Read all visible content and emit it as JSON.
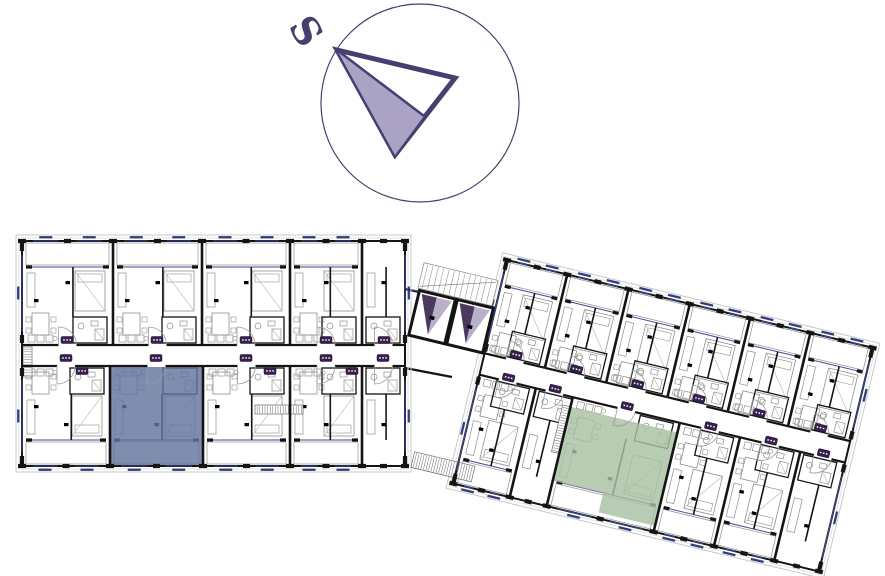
{
  "compass": {
    "label": "S",
    "cx": 420,
    "cy": 103,
    "r": 99,
    "ring_color": "#43406e",
    "arrow_outline": "#463f70",
    "arrow_fill": "#aba3c6",
    "label_color": "#463f70",
    "tip": [
      337,
      50
    ],
    "right": [
      455,
      78
    ],
    "bottom": [
      395,
      155
    ],
    "mid": [
      424,
      116
    ],
    "label_pos": [
      303,
      33
    ],
    "label_rotate": 58,
    "label_size": 38
  },
  "palette": {
    "wall": "#141414",
    "furniture": "#8f8f8f",
    "thin": "#b5b5b5",
    "window": "#3c4a96",
    "sill": "#1b2a6b",
    "badge": "#38204e",
    "badge_dot": "#ffffff",
    "insulation": "#c9c9c9",
    "insulation2": "#e2e2e2",
    "elev_dark": "#4a3b5e",
    "elev_light": "#b9b0ca",
    "door": "#9a9a9a"
  },
  "buildings": [
    {
      "name": "left-building",
      "origin": [
        22,
        241
      ],
      "rotate": 0,
      "w": 383,
      "h": 225,
      "corridor": [
        104,
        125
      ],
      "top_dividers": [
        91,
        180,
        268,
        340
      ],
      "bottom_dividers": [
        88,
        181,
        268,
        340
      ],
      "highlight": {
        "name": "blue-highlighted-apartment",
        "color": "#63749c",
        "poly": [
          [
            88,
            126
          ],
          [
            181,
            126
          ],
          [
            181,
            225
          ],
          [
            88,
            225
          ]
        ]
      },
      "badges": [
        [
          45,
          99
        ],
        [
          135,
          99
        ],
        [
          224,
          99
        ],
        [
          304,
          99
        ],
        [
          362,
          99
        ],
        [
          44,
          117
        ],
        [
          134,
          117
        ],
        [
          224,
          117
        ],
        [
          304,
          117
        ],
        [
          361,
          117
        ],
        [
          60,
          130
        ],
        [
          248,
          130
        ],
        [
          330,
          130
        ]
      ],
      "hatches": [
        {
          "x": 1,
          "y": 106,
          "w": 9,
          "h": 30
        },
        {
          "x": 233,
          "y": 164,
          "w": 48,
          "h": 9
        }
      ]
    },
    {
      "name": "right-building",
      "origin": [
        507,
        260
      ],
      "rotate": 13.5,
      "w": 376,
      "h": 230,
      "corridor": [
        96,
        118
      ],
      "top_dividers": [
        62,
        125,
        188,
        250,
        312
      ],
      "bottom_dividers": [
        58,
        96,
        206,
        268,
        330
      ],
      "highlight": {
        "name": "green-highlighted-apartment",
        "color": "#a8bfa2",
        "poly": [
          [
            96,
            128
          ],
          [
            206,
            128
          ],
          [
            206,
            224
          ],
          [
            148,
            224
          ],
          [
            148,
            204
          ],
          [
            96,
            204
          ]
        ]
      },
      "badges": [
        [
          31,
          90
        ],
        [
          93,
          90
        ],
        [
          156,
          90
        ],
        [
          219,
          90
        ],
        [
          281,
          90
        ],
        [
          344,
          90
        ],
        [
          29,
          114
        ],
        [
          77,
          114
        ],
        [
          151,
          114
        ],
        [
          237,
          114
        ],
        [
          299,
          114
        ],
        [
          353,
          114
        ]
      ],
      "hatches": [
        {
          "x": 88,
          "y": 128,
          "w": 8,
          "h": 48
        },
        {
          "x": -45,
          "y": 208,
          "w": 62,
          "h": 16
        }
      ],
      "core": {
        "stairs": {
          "x": -80,
          "y": 22,
          "w": 76,
          "h": 26
        },
        "shafts": [
          {
            "x": -78,
            "y": 50,
            "w": 37,
            "h": 46
          },
          {
            "x": -39,
            "y": 50,
            "w": 37,
            "h": 46
          }
        ]
      }
    }
  ],
  "connector": {
    "top_wall": [
      [
        405,
        289
      ],
      [
        510,
        311
      ]
    ],
    "bottom_wall": [
      [
        405,
        368
      ],
      [
        452,
        377
      ]
    ]
  }
}
